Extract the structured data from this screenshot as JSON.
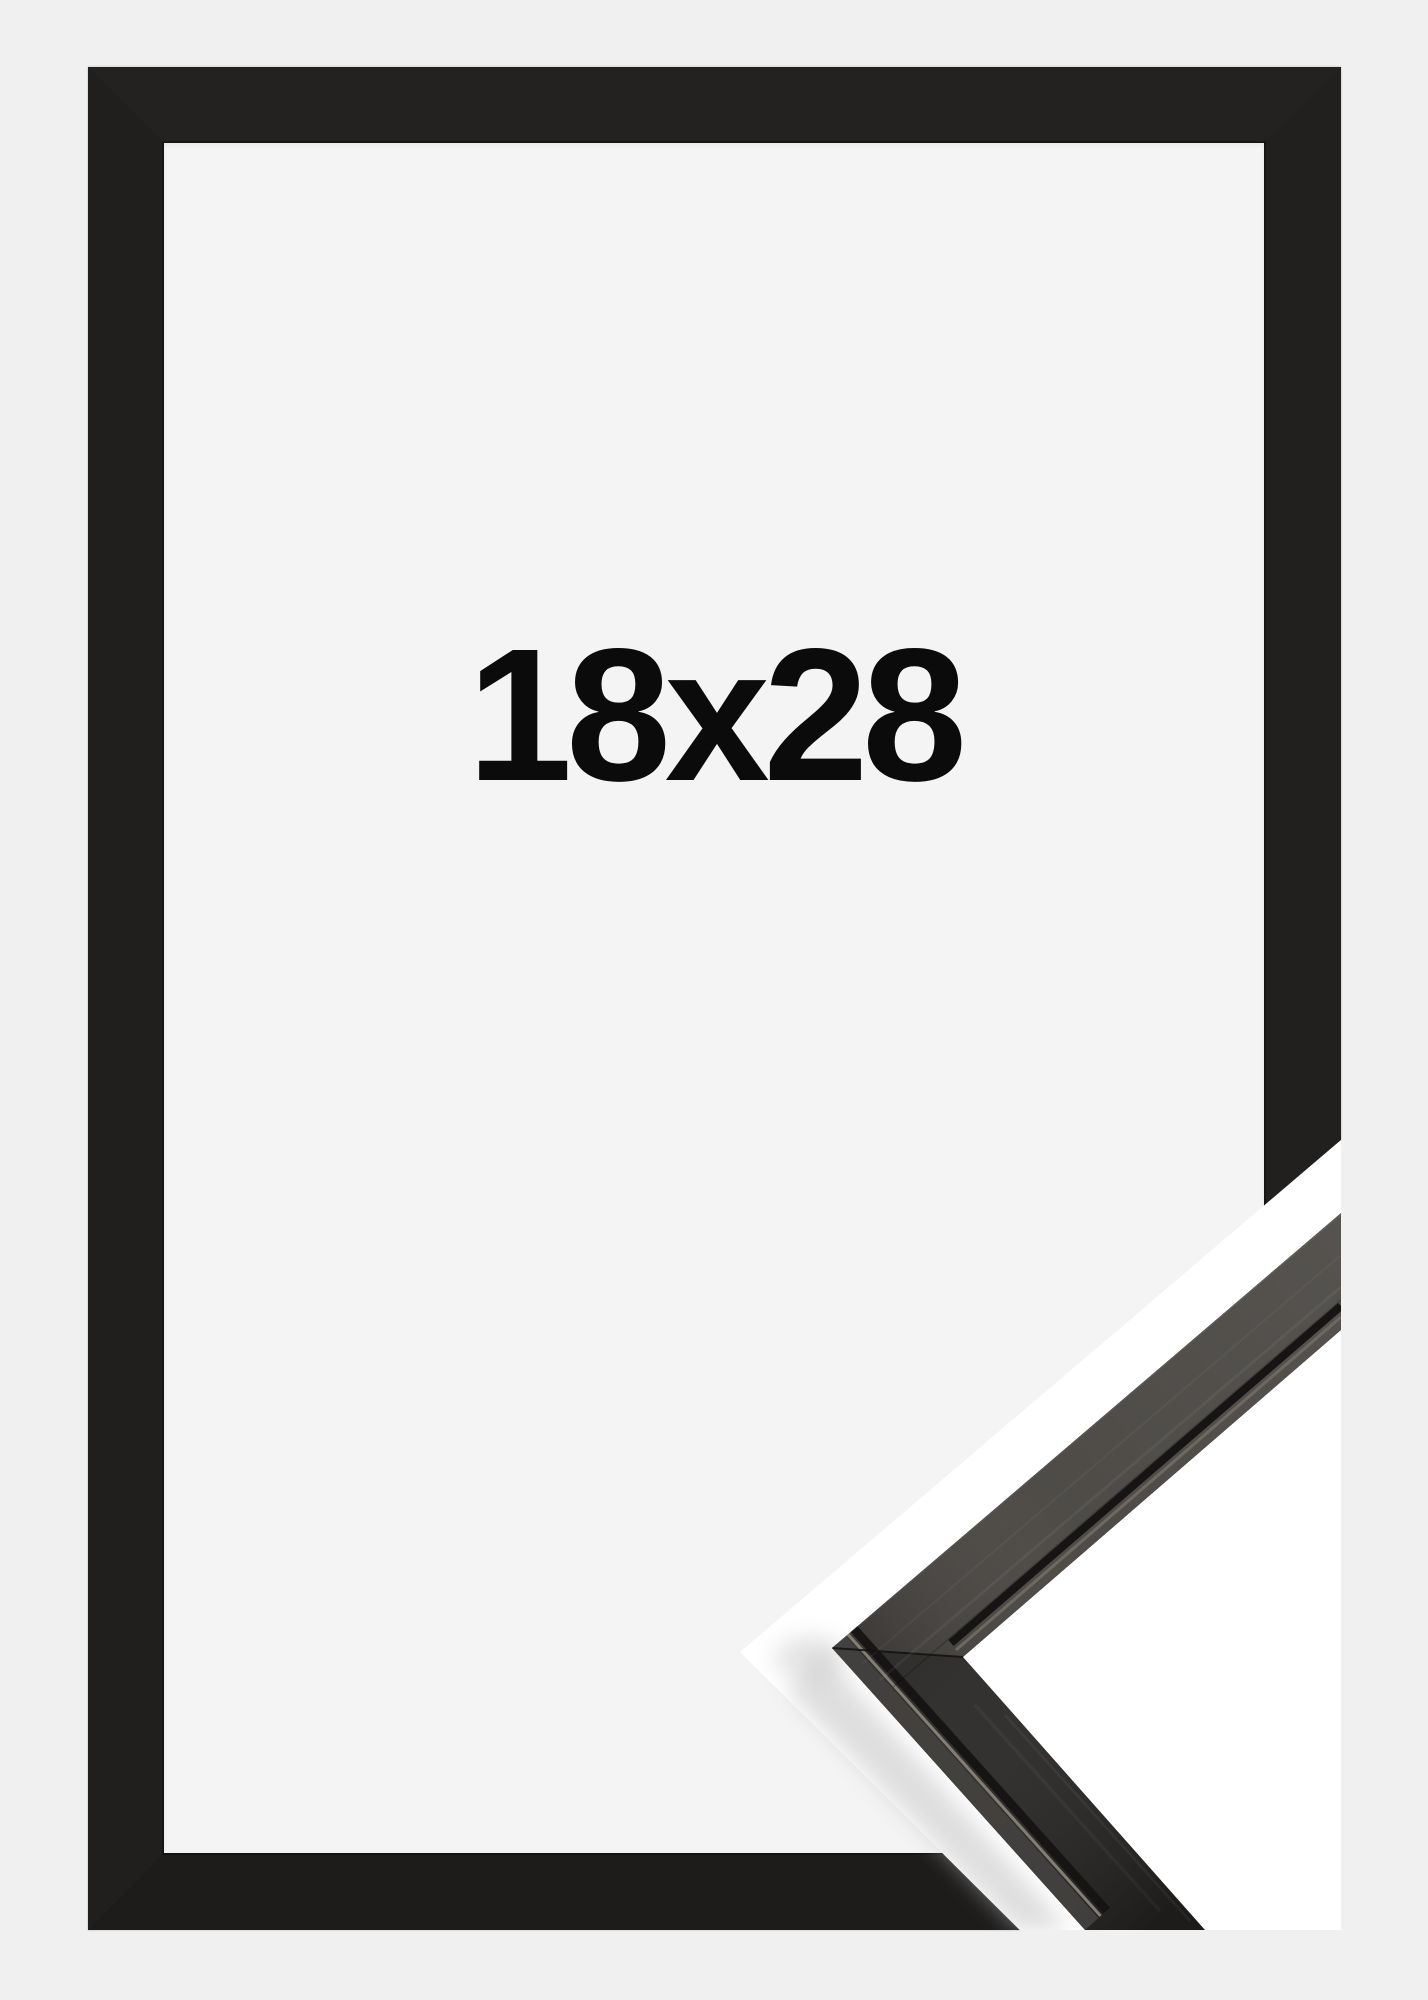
{
  "product": {
    "size_label": "18x28"
  },
  "colors": {
    "page_bg": "#f0f0f1",
    "opening_bg": "#f4f4f5",
    "label_text": "#0b0b0b",
    "frame_top": "#232221",
    "frame_right": "#21201f",
    "frame_bottom": "#1d1c1b",
    "frame_left": "#201f1e",
    "divider_white": "#ffffff",
    "profile_face_upper": "#45423e",
    "profile_face_lower": "#262422",
    "profile_side_strip": "#454240",
    "profile_lip_highlight": "#837d73",
    "profile_groove": "#161514",
    "shadow": "#bdbdbd"
  }
}
